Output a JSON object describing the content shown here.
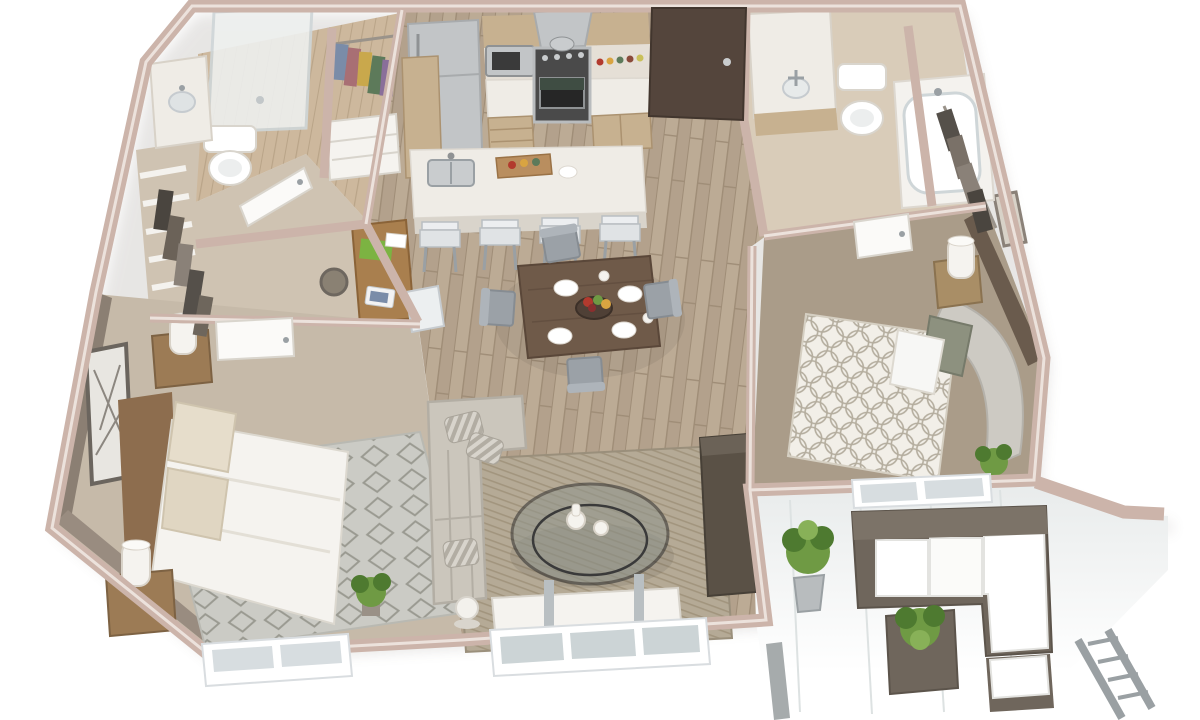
{
  "scene": {
    "kind": "3d-floorplan-cutaway-render",
    "style": "photorealistic dollhouse perspective of a two-bedroom apartment, white background, no visible text",
    "no_visible_text": true,
    "rooms": [
      {
        "name": "kitchen",
        "floor": "hardwood",
        "items": [
          "refrigerator",
          "wall cabinets",
          "microwave",
          "range hood",
          "stove-oven",
          "base cabinets",
          "island with sink",
          "four bar stools",
          "cutting board with food"
        ]
      },
      {
        "name": "dining-area",
        "floor": "hardwood",
        "items": [
          "dark wood table",
          "four gray chairs",
          "fruit bowl",
          "white plates",
          "cups"
        ]
      },
      {
        "name": "living-room",
        "floor": "hardwood",
        "items": [
          "light gray L-sofa",
          "striped pillows",
          "round glass coffee table",
          "two white vases",
          "geometric area rug",
          "dark tv console",
          "floor lamp",
          "white media bench",
          "glass slider window"
        ]
      },
      {
        "name": "master-bedroom",
        "floor": "carpet",
        "items": [
          "wood platform bed",
          "white duvet",
          "patterned pillows",
          "two wood nightstands",
          "two white lamps",
          "diamond pattern rug",
          "framed art",
          "potted plant",
          "double window"
        ]
      },
      {
        "name": "master-closet",
        "items": [
          "wire shelf baskets",
          "hanging dark clothes"
        ]
      },
      {
        "name": "bedroom-2",
        "floor": "carpet",
        "items": [
          "upholstered curved bed frame",
          "circle-lattice duvet",
          "accent pillows",
          "white pillow",
          "wood nightstand",
          "white lamp",
          "framed art",
          "potted plant",
          "dark brown accent wall",
          "window"
        ]
      },
      {
        "name": "bathroom-1",
        "items": [
          "glass shower",
          "toilet",
          "vanity with sink"
        ]
      },
      {
        "name": "reach-in-closet",
        "items": [
          "colorful hanging clothes",
          "white dresser"
        ]
      },
      {
        "name": "bathroom-2",
        "items": [
          "vanity with mirror",
          "toilet",
          "bathtub"
        ]
      },
      {
        "name": "walk-in-closet-2",
        "items": [
          "hanging dark clothes"
        ]
      },
      {
        "name": "entry",
        "items": [
          "dark brown front door with silver handle"
        ]
      },
      {
        "name": "desk-nook",
        "items": [
          "wood desk",
          "laptop",
          "green binder",
          "woven basket",
          "white chair"
        ]
      },
      {
        "name": "patio",
        "items": [
          "outdoor sectional with white cushions",
          "white ottoman",
          "dark cube planter with plant",
          "potted shrub",
          "gray railing",
          "gray post"
        ]
      }
    ]
  },
  "palette": {
    "bg": "#ffffff",
    "wallTop": "#ccb4aa",
    "wallTopDark": "#b89e93",
    "wallFace": "#f1ede9",
    "wallTaupe": "#8b7f73",
    "wallDark": "#6a5b4d",
    "doorDark": "#54453c",
    "woodBase": "#b3a18c",
    "woodStreak": "#9f8d77",
    "woodLight": "#c2b29d",
    "bathFloor": "#cdb89d",
    "bath2Floor": "#d9ccb9",
    "hallCarpet": "#cfc3b2",
    "carpet1": "#c6baa9",
    "carpet2": "#aa9c89",
    "counter": "#efece6",
    "cabinet": "#c7b190",
    "stainless": "#c2c5c7",
    "appliance": "#3c3c3c",
    "tableWood": "#6f5a49",
    "chairGray": "#9ba1a7",
    "sofa": "#cbc6bc",
    "rugLiving": "#b5aa96",
    "rugMaster": "#cbcbc5",
    "glass": "#90968e",
    "tvConsole": "#5a5146",
    "patioSofa": "#6f665c",
    "cushion": "#f7f7f5",
    "plant": "#6f9a44",
    "plantDark": "#4e7a30",
    "rail": "#9aa0a3",
    "white": "#f5f3ef",
    "bedWood": "#8d6d4e",
    "nstand": "#9c7b55"
  }
}
